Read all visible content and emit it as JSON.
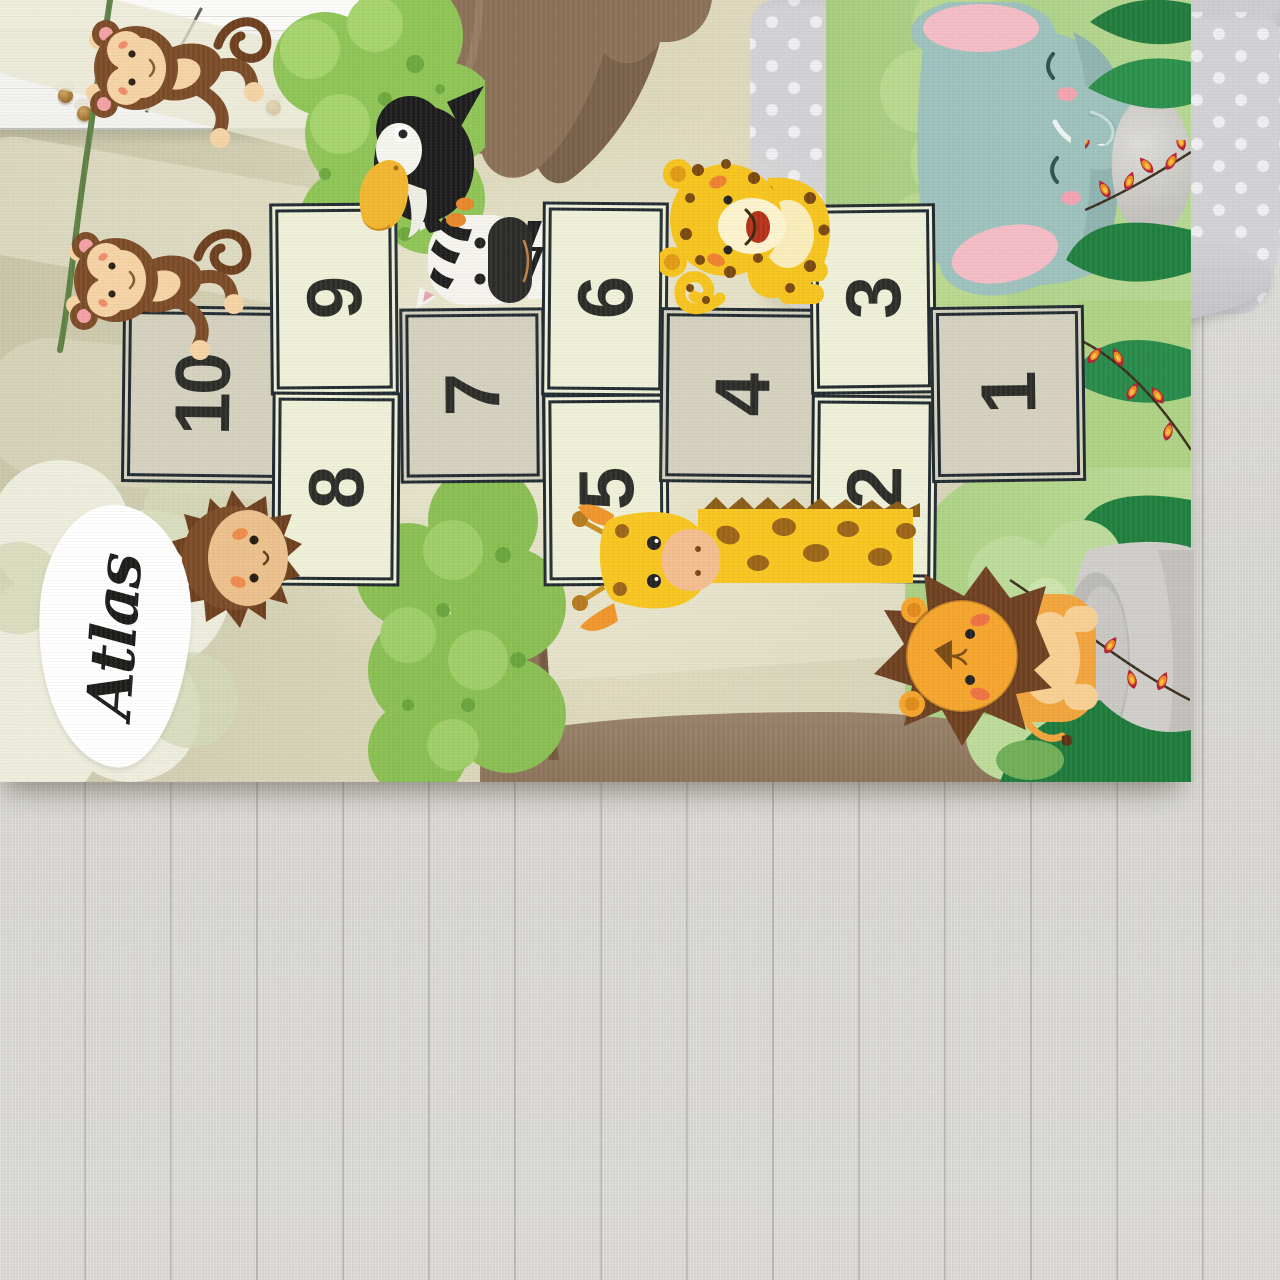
{
  "rug": {
    "name_label": "Atlas",
    "squares": [
      "10",
      "9",
      "8",
      "7",
      "6",
      "5",
      "4",
      "3",
      "2",
      "1"
    ],
    "animal_illustrations": [
      "hanging-monkey",
      "swinging-monkey",
      "toucan",
      "zebra",
      "leopard-cub",
      "elephant",
      "giraffe",
      "lion-cub",
      "hedgehog"
    ],
    "colors": {
      "rug_base": "#d6d3b6",
      "square_cream": "#eef0d8",
      "square_tan": "#d4d1bf",
      "square_border": "#202a30",
      "number_ink": "#2b2b28",
      "foliage_green": "#8ec455",
      "dark_leaf_green": "#207b3c",
      "trunk_brown": "#8a7056",
      "path_brown": "#937c5f",
      "berry_red": "#b32031",
      "berry_orange": "#ef8c1f"
    }
  },
  "pouf": {
    "text": "CUTTY CAT"
  }
}
